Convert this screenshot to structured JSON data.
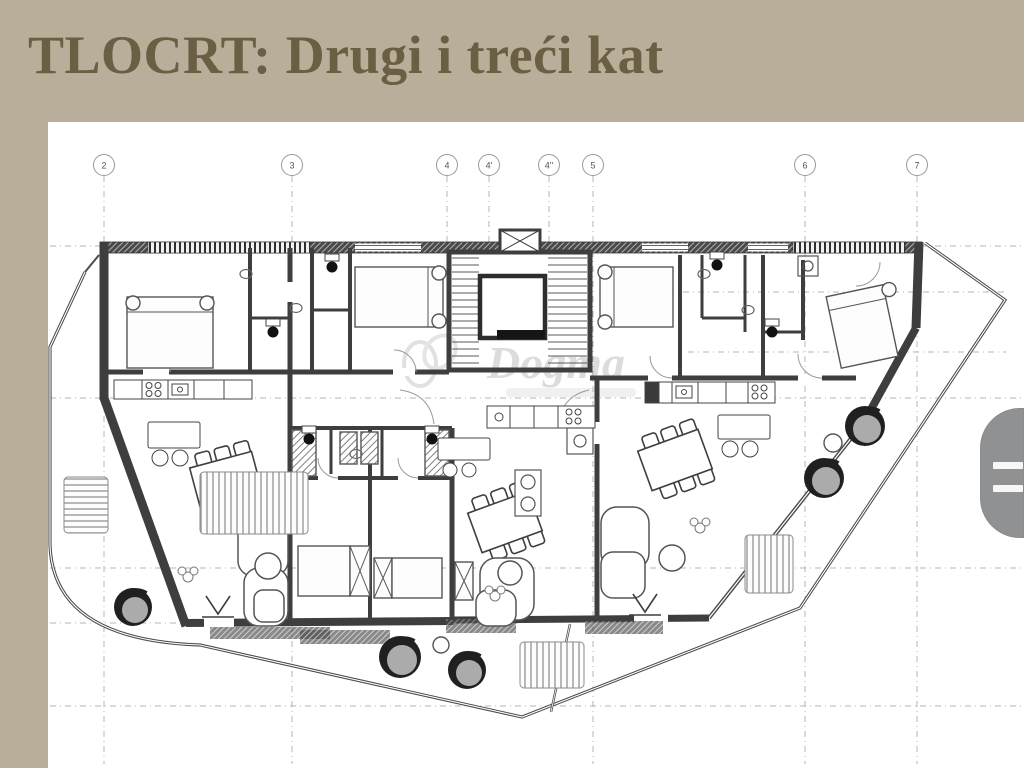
{
  "header": {
    "title": "TLOCRT: Drugi i treći kat"
  },
  "colors": {
    "header_bg": "#b9ae9a",
    "header_text": "#6a5f42",
    "plan_ink": "#3e3e3e",
    "grid_line": "#b5b5b5",
    "tab_gray": "#8f9193"
  },
  "plan": {
    "grid_markers": [
      {
        "label": "2"
      },
      {
        "label": "3"
      },
      {
        "label": "4"
      },
      {
        "label": "4'"
      },
      {
        "label": "4''"
      },
      {
        "label": "5"
      },
      {
        "label": "6"
      },
      {
        "label": "7"
      }
    ],
    "watermark": {
      "text": "Dogma"
    }
  }
}
